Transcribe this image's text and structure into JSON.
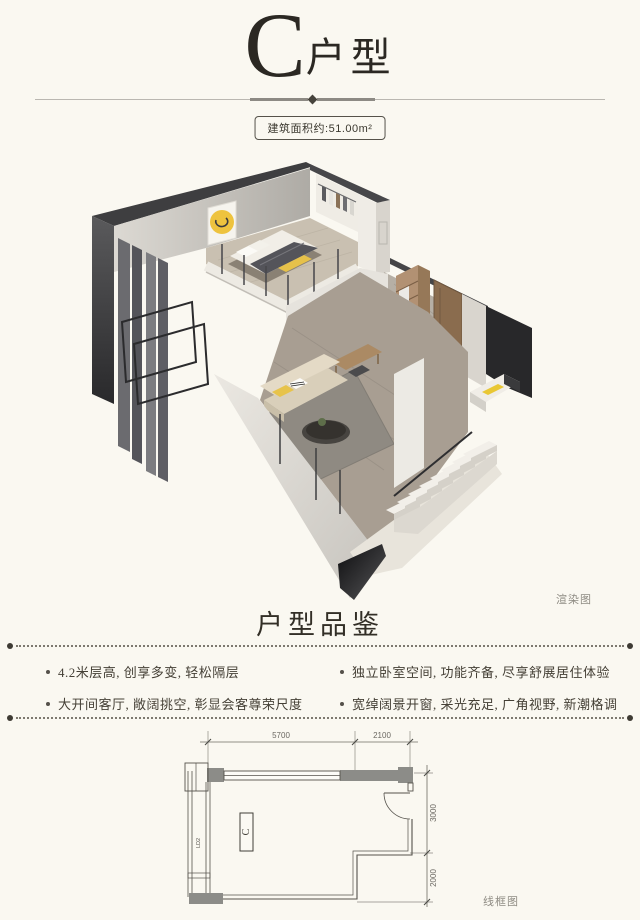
{
  "page": {
    "background": "#faf8f1"
  },
  "header": {
    "unit_letter": "C",
    "unit_type_suffix": "户型",
    "area_badge": "建筑面积约:51.00m²"
  },
  "render_section": {
    "caption": "渲染图",
    "accent_colors": {
      "yellow": "#eec33e",
      "teal": "#6d9495",
      "wood": "#a98862",
      "dark_wall": "#3a3a3c",
      "cream": "#faf8f1"
    }
  },
  "features_section": {
    "title": "户型品鉴",
    "items": [
      {
        "text": "4.2米层高, 创享多变, 轻松隔层"
      },
      {
        "text": "大开间客厅, 敞阔挑空, 彰显会客尊荣尺度"
      },
      {
        "text": "独立卧室空间, 功能齐备, 尽享舒展居住体验"
      },
      {
        "text": "宽绰阔景开窗, 采光充足, 广角视野, 新潮格调"
      }
    ]
  },
  "floorplan_section": {
    "caption": "线框图",
    "unit_label": "C",
    "window_tag": "LD2",
    "dimensions": {
      "top": [
        "5700",
        "2100"
      ],
      "right": [
        "3000",
        "2000"
      ]
    }
  }
}
